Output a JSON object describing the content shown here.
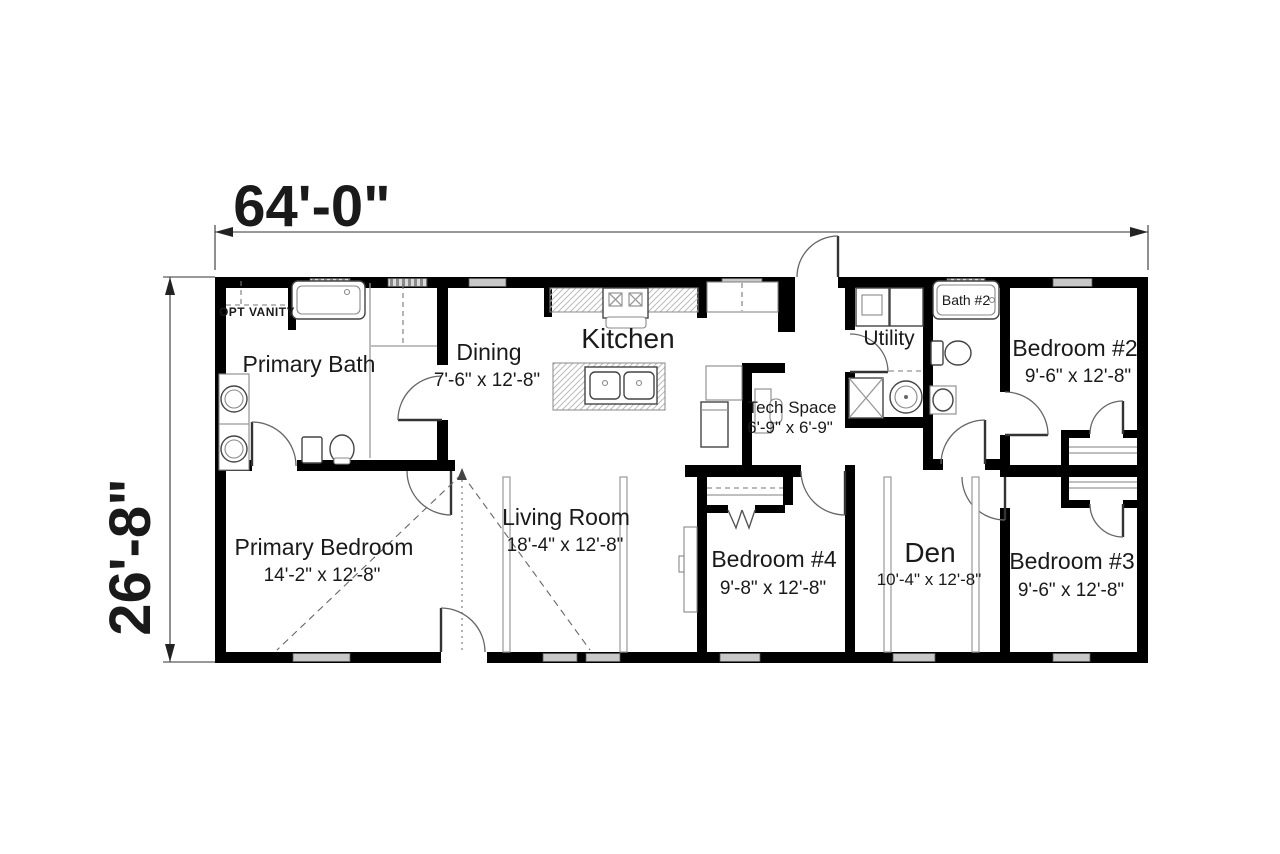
{
  "plan": {
    "dimension_width": "64'-0\"",
    "dimension_height": "26'-8\"",
    "rooms": {
      "primary_bath": {
        "name": "Primary Bath"
      },
      "dining": {
        "name": "Dining",
        "dims": "7'-6\" x 12'-8\""
      },
      "kitchen": {
        "name": "Kitchen"
      },
      "tech_space": {
        "name": "Tech Space",
        "dims": "6'-9\" x 6'-9\""
      },
      "utility": {
        "name": "Utility"
      },
      "bath2": {
        "name": "Bath #2"
      },
      "bedroom2": {
        "name": "Bedroom #2",
        "dims": "9'-6\" x 12'-8\""
      },
      "primary_bedroom": {
        "name": "Primary Bedroom",
        "dims": "14'-2\" x 12'-8\""
      },
      "living_room": {
        "name": "Living Room",
        "dims": "18'-4\" x 12'-8\""
      },
      "bedroom4": {
        "name": "Bedroom #4",
        "dims": "9'-8\" x 12'-8\""
      },
      "den": {
        "name": "Den",
        "dims": "10'-4\" x 12'-8\""
      },
      "bedroom3": {
        "name": "Bedroom #3",
        "dims": "9'-6\" x 12'-8\""
      }
    },
    "annotations": {
      "opt_vanity": "OPT VANITY"
    },
    "colors": {
      "wall": "#000000",
      "window_fill": "#c8c8c8",
      "text": "#1a1a1a",
      "background": "#ffffff"
    }
  }
}
